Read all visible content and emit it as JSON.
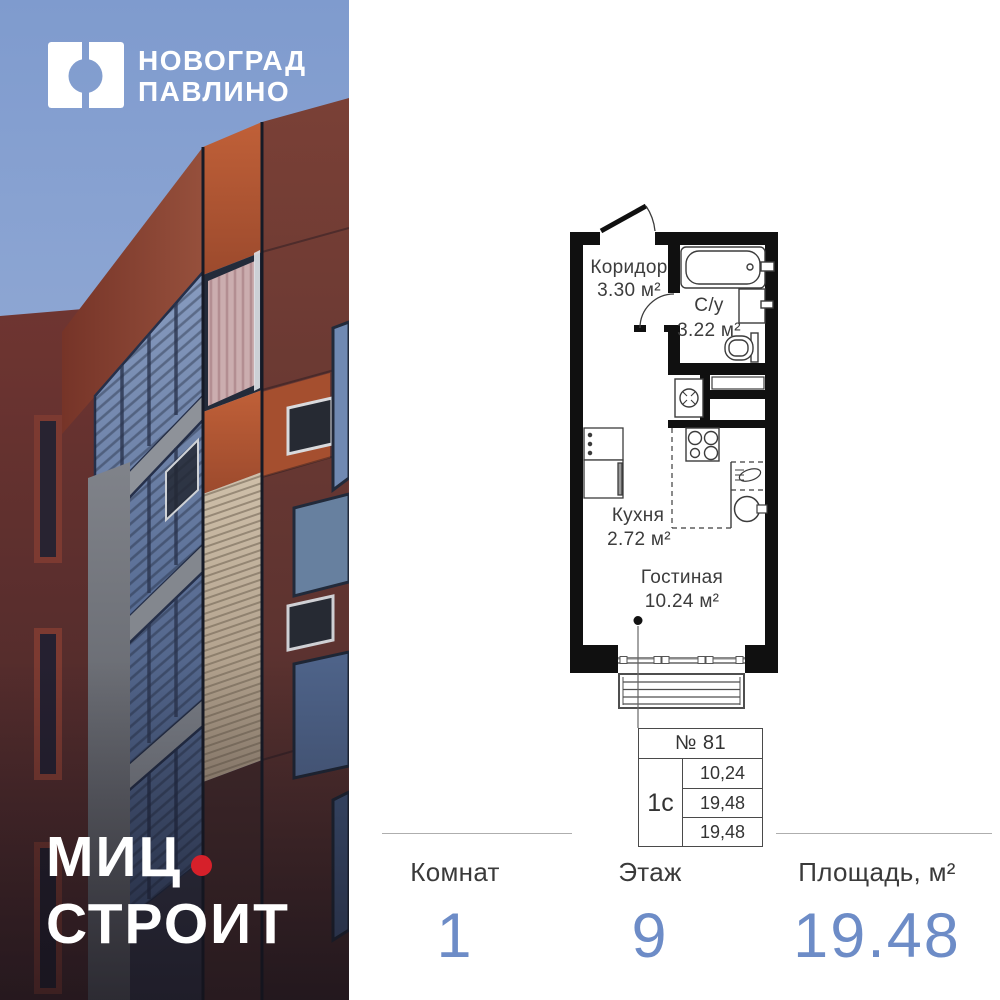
{
  "brand": {
    "project_logo": {
      "line1": "НОВОГРАД",
      "line2": "ПАВЛИНО"
    },
    "developer": {
      "word1": "МИЦ",
      "word2": "СТРОИТ",
      "dot_color": "#d6202a"
    }
  },
  "floor_plan": {
    "rooms": [
      {
        "name": "Коридор",
        "area": "3.30 м²"
      },
      {
        "name": "С/у",
        "area": "3.22 м²"
      },
      {
        "name": "Кухня",
        "area": "2.72 м²"
      },
      {
        "name": "Гостиная",
        "area": "10.24 м²"
      }
    ],
    "unit_table": {
      "number": "№ 81",
      "type": "1с",
      "rows": [
        "10,24",
        "19,48",
        "19,48"
      ]
    }
  },
  "summary": {
    "columns": [
      {
        "label": "Комнат",
        "value": "1"
      },
      {
        "label": "Этаж",
        "value": "9"
      },
      {
        "label": "Площадь, м²",
        "value": "19.48"
      }
    ],
    "value_color": "#6d8cc7"
  }
}
